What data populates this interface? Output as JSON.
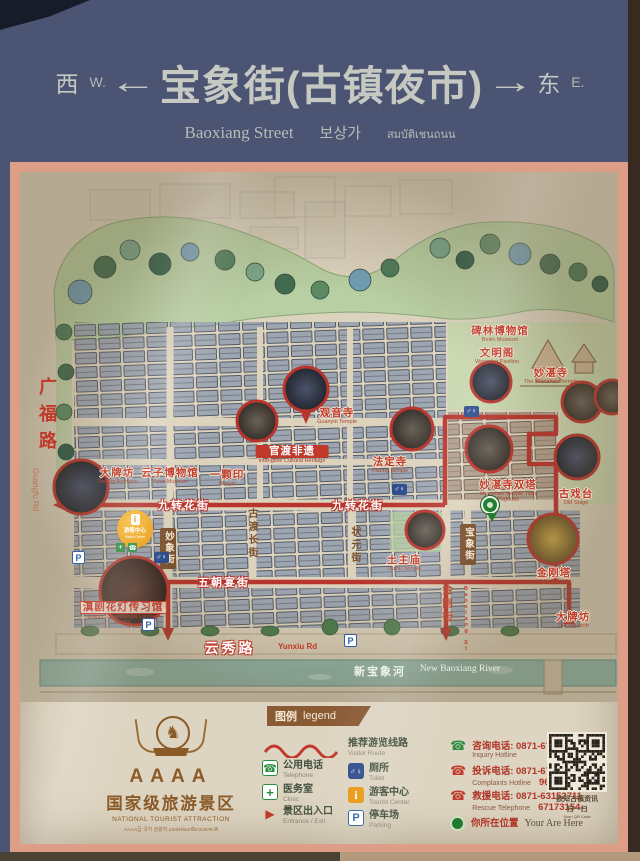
{
  "header": {
    "west_zh": "西",
    "west_en": "W.",
    "arrow_left": "←",
    "title": "宝象街(古镇夜市)",
    "arrow_right": "→",
    "east_zh": "东",
    "east_en": "E.",
    "sub_en": "Baoxiang Street",
    "sub_kr": "보상가",
    "sub_th": "สมบัติเชนถนน"
  },
  "icons": {
    "parking": "P",
    "toilet": "♂♀",
    "info": "i",
    "cross": "+",
    "phone": "☎",
    "entrance": "▶",
    "horse": "♞"
  },
  "map": {
    "streets": {
      "guangfu_zh": "广福路",
      "guangfu_en": "Guangfu Rd",
      "jiuzhuan": "九转花街",
      "wuchao": "五朝宴街",
      "zhuangyuan": "状元街",
      "miaoxiang": "妙象街",
      "gudu": "古渡长街",
      "jingang": "金刚街",
      "baoxiang_zh": "宝象街",
      "baoxiang_en": "Baoxiang St",
      "yunxiu_zh": "云秀路",
      "yunxiu_en": "Yunxiu Rd",
      "river_zh": "新宝象河",
      "river_en": "New Baoxiang River"
    },
    "pois": [
      {
        "zh": "大牌坊",
        "en": "The Big Archway"
      },
      {
        "zh": "云子博物馆",
        "en": "Yunzi Museum"
      },
      {
        "zh": "一颗印",
        "en": "Yikeyin"
      },
      {
        "zh": "观音寺",
        "en": "Guanyin Temple"
      },
      {
        "zh": "官渡非遗",
        "en": "Intangible Cultural Heritage"
      },
      {
        "zh": "法定寺",
        "en": "Fading Temple"
      },
      {
        "zh": "碑林博物馆",
        "en": "Beilin Museum"
      },
      {
        "zh": "文明阁",
        "en": "Wenming Pavilion"
      },
      {
        "zh": "妙湛寺",
        "en": "The Miaozhan Temple"
      },
      {
        "zh": "妙湛寺双塔",
        "en": "Miaozhan Temple Twin Pagodas"
      },
      {
        "zh": "古戏台",
        "en": "Old Stage"
      },
      {
        "zh": "金刚塔",
        "en": "Vajra Pagoda"
      },
      {
        "zh": "土主庙",
        "en": "Tuzhu Temple"
      },
      {
        "zh": "大牌坊",
        "en": "The Big Arch"
      },
      {
        "zh": "滇剧花灯传习馆",
        "en": "Dianju Chuandengxi Lantern Center"
      }
    ],
    "visitor_center": {
      "zh": "游客中心",
      "en": "Visitor Center"
    }
  },
  "legend": {
    "title_zh": "图例",
    "title_en": "legend",
    "route": {
      "zh": "推荐游览线路",
      "en": "Visitor Route"
    },
    "col1": [
      {
        "zh": "公用电话",
        "en": "Telephone"
      },
      {
        "zh": "医务室",
        "en": "Clinic"
      },
      {
        "zh": "景区出入口",
        "en": "Entrance / Exit"
      }
    ],
    "col2": [
      {
        "zh": "厕所",
        "en": "Toilet"
      },
      {
        "zh": "游客中心",
        "en": "Tourist Center"
      },
      {
        "zh": "停车场",
        "en": "Parking"
      }
    ],
    "hotlines": [
      {
        "zh": "咨询电话: 0871-67262799",
        "en": "Inquiry Hotline",
        "num2": ""
      },
      {
        "zh": "投诉电话: 0871-67262799",
        "en": "Complaints Hotline",
        "num2": "96927"
      },
      {
        "zh": "救援电话: 0871-63152711",
        "en": "Rescue Telephone",
        "num2": "67173154"
      },
      {
        "zh": "你所在位置",
        "en": "Your Are Here",
        "num2": ""
      }
    ],
    "qr": {
      "line1": "欲知古镇资讯",
      "line2": "扫一扫",
      "line3": "Scan QR Code"
    }
  },
  "emblem": {
    "grade": "AAAA",
    "zh": "国家级旅游景区",
    "en": "NATIONAL TOURIST ATTRACTION",
    "sub": "AAAA급 국가 관광지 แหล่งท่องเที่ยวแห่งชาติ"
  }
}
